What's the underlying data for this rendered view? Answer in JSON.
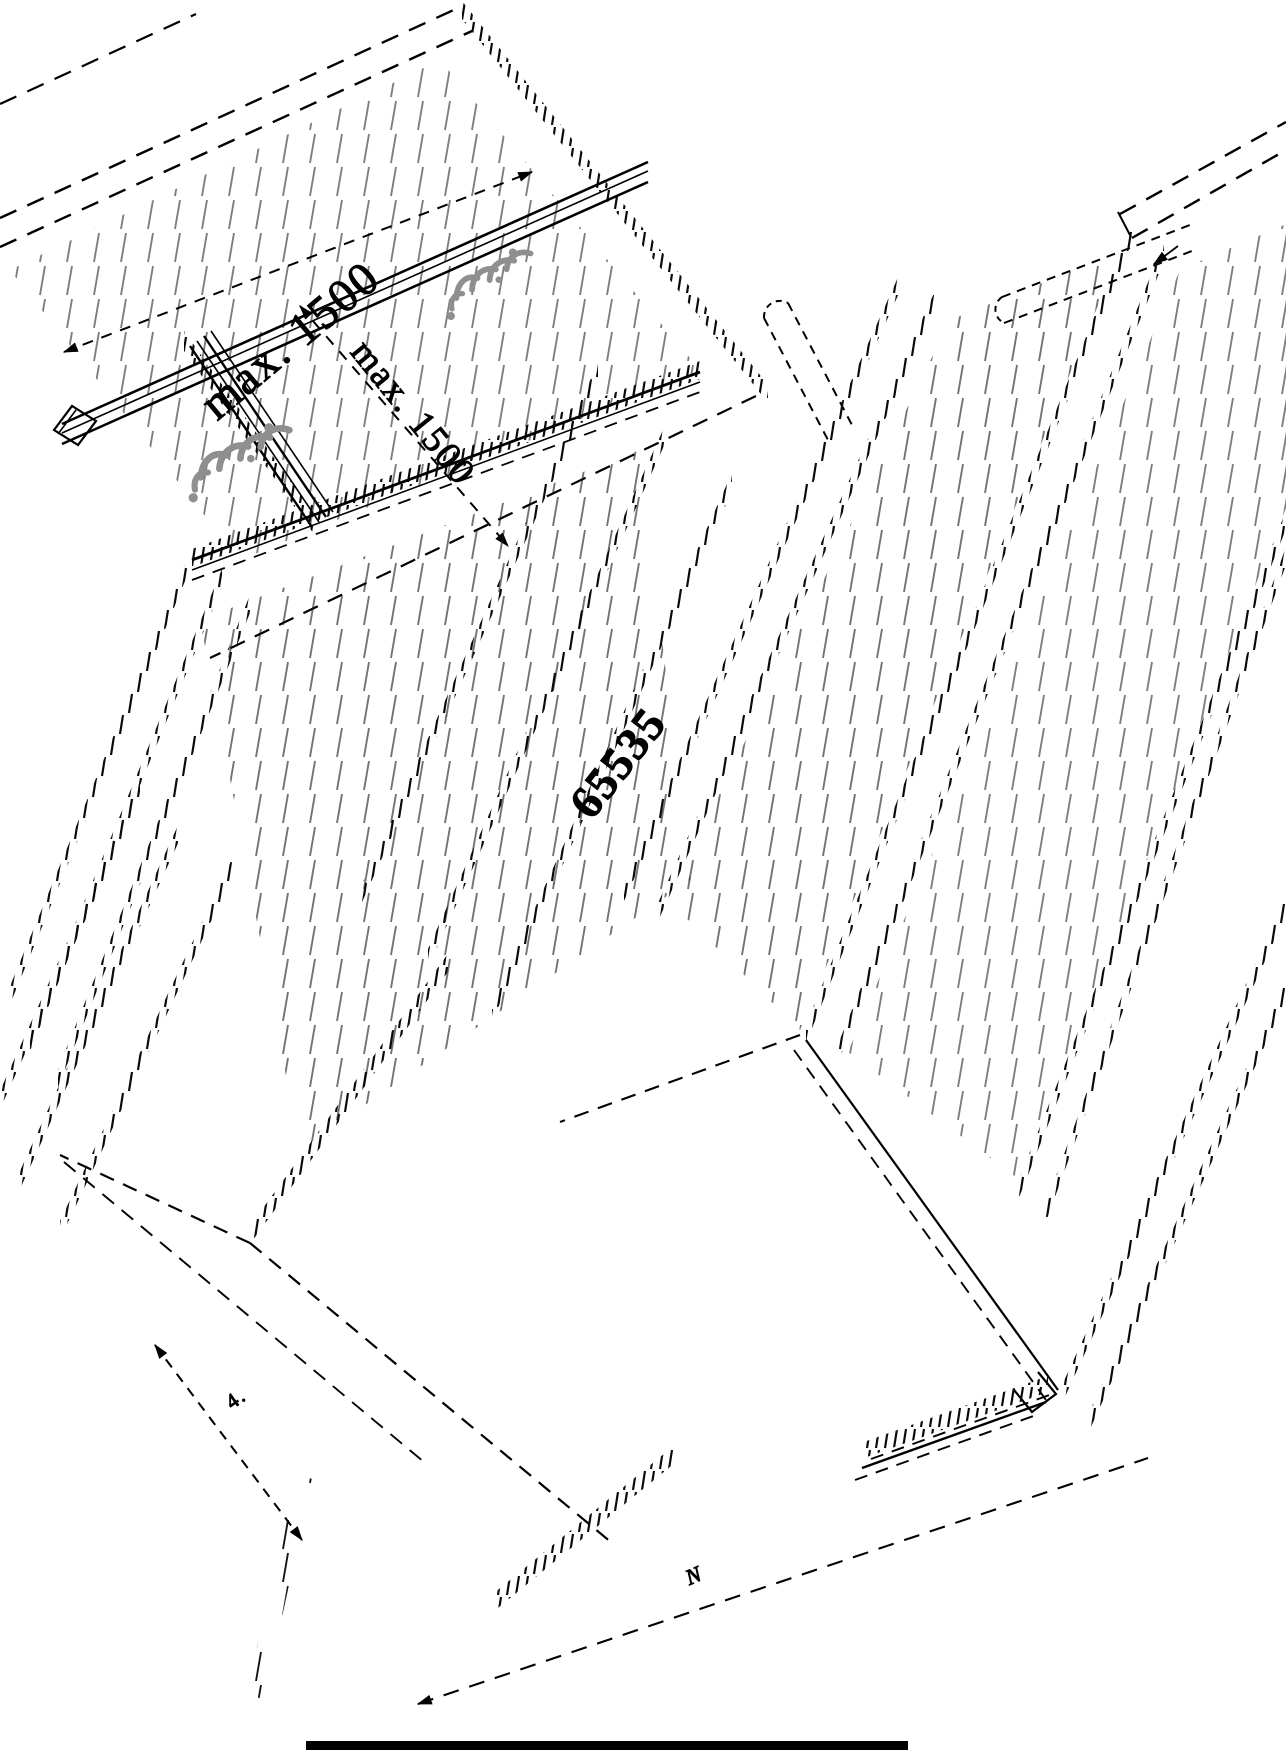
{
  "drawing": {
    "description": "isometric installation drawing of decking boards on mounting rails",
    "background": "#ffffff",
    "ink_color": "#000000",
    "clip_color": "#8f8f8f",
    "labels": {
      "dim_top_rail_spacing": "max. 1500",
      "dim_side_rail_spacing": "max. 1500",
      "dim_board_seam": "65535",
      "dim_small_width": "4.",
      "dim_small_length": "N"
    }
  }
}
